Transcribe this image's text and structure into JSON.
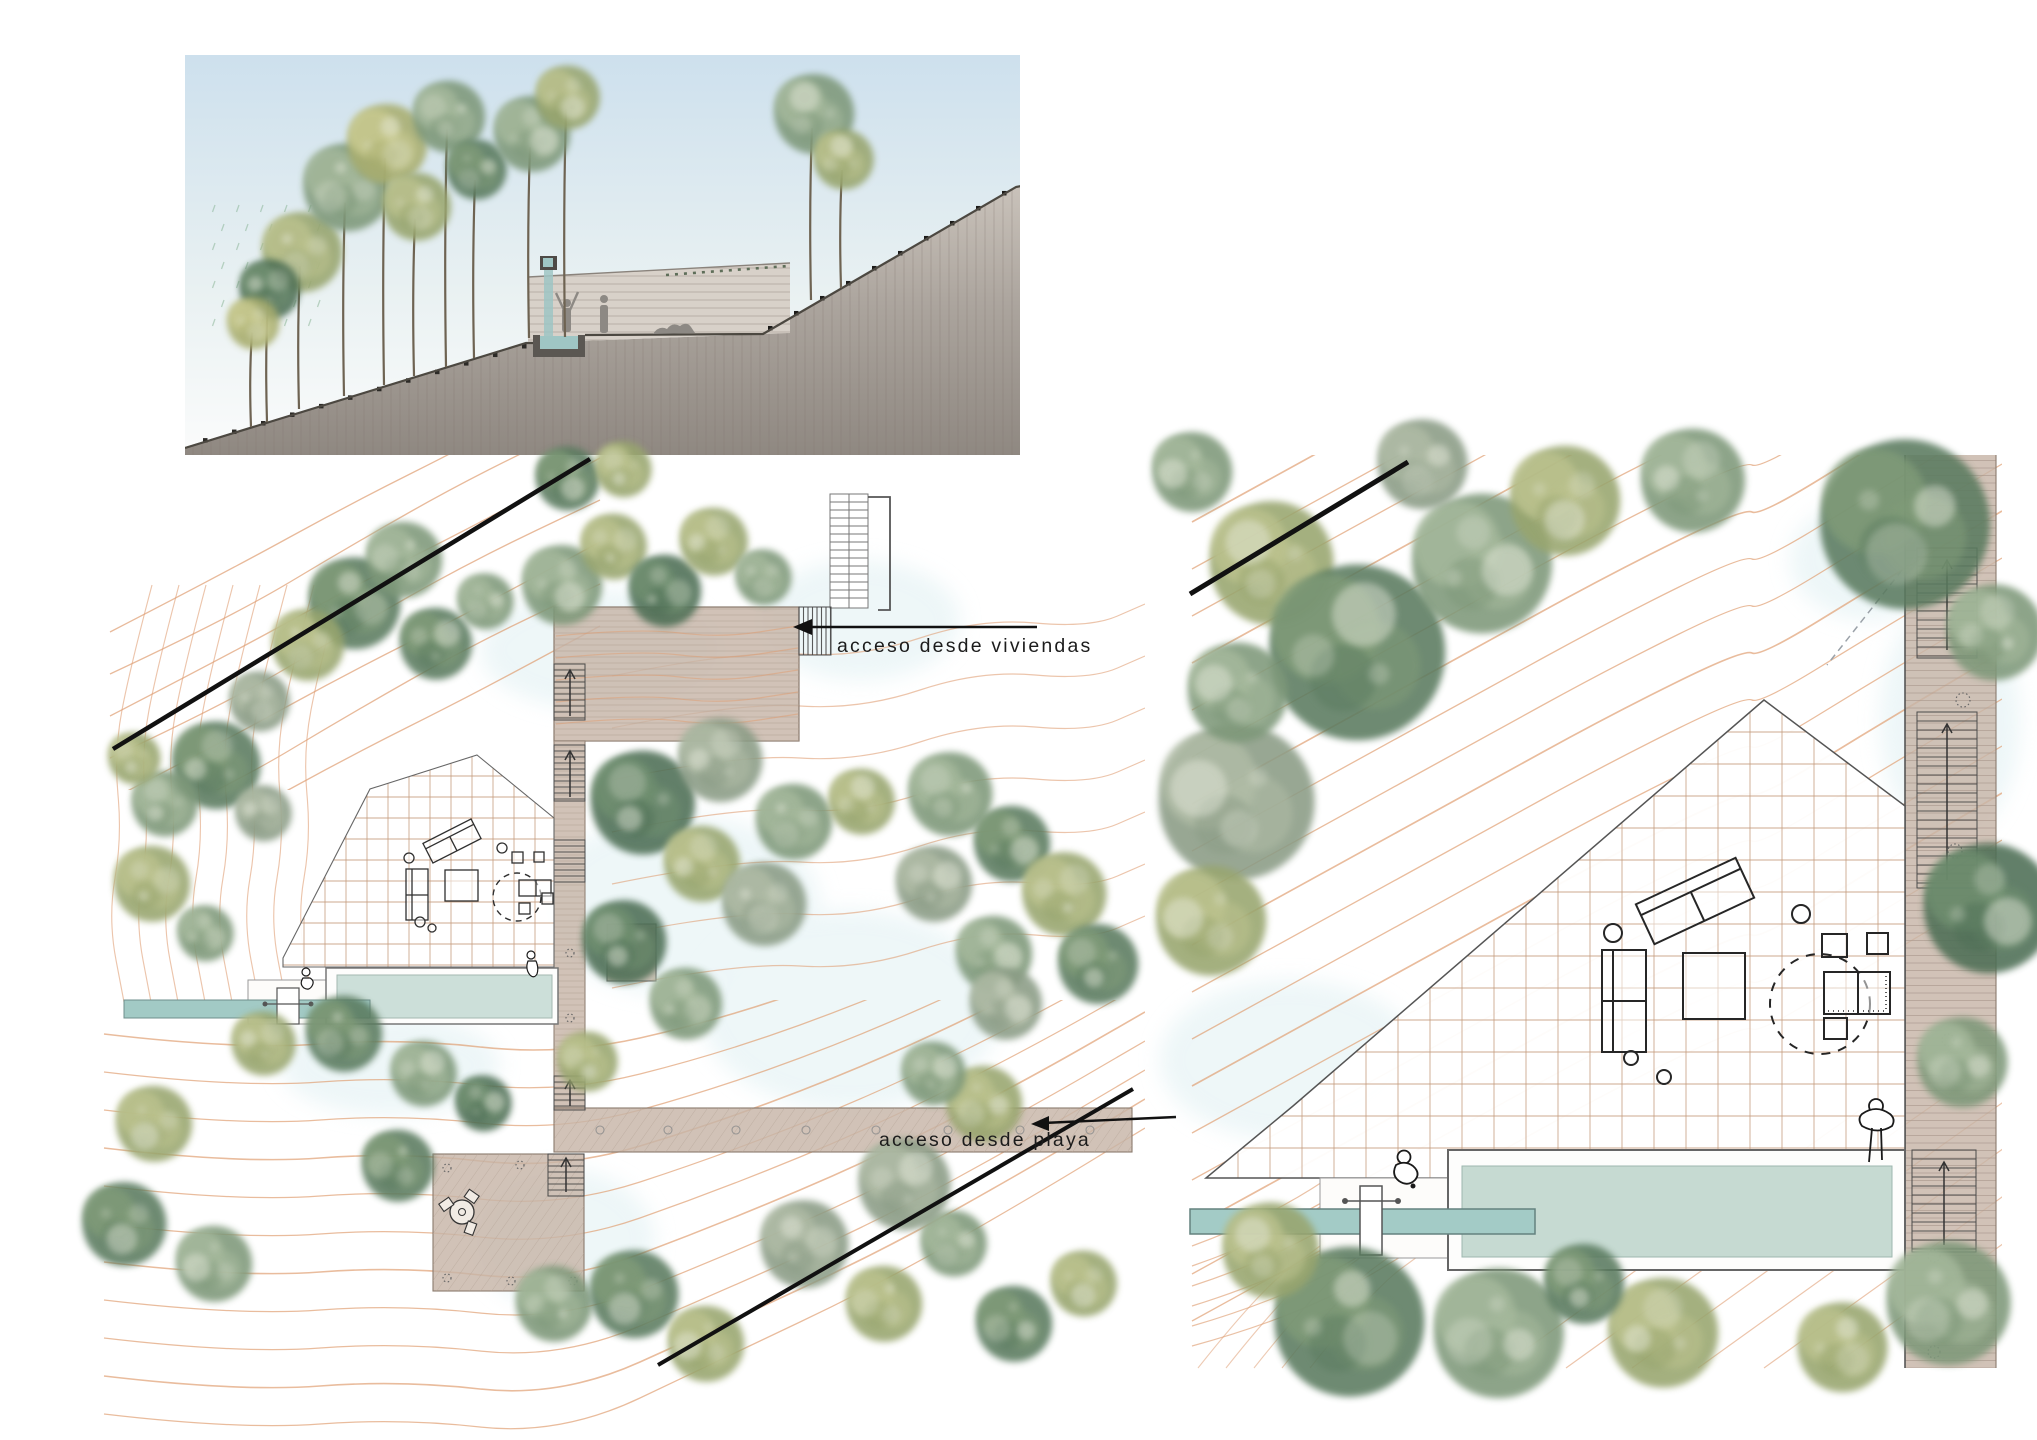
{
  "drawing": {
    "kind": "landscape architecture presentation",
    "labels": {
      "access_viviendas": "acceso desde viviendas",
      "access_playa": "acceso desde playa"
    },
    "palette": {
      "contour": "#df9f74",
      "deck_timber": "#c7b5a7",
      "pool_water": "#ccdfd9",
      "pool_water_detail": "#c6dad2",
      "water_channel": "#a3cbc6",
      "sky_top": "#cde0ed",
      "ground_wash": "#948d86",
      "boundary_line": "#111111",
      "tree_greens": [
        "#5a7a5e",
        "#7e9879",
        "#98a56e",
        "#8a9b85",
        "#a9ae6f",
        "#4e6e54"
      ]
    }
  }
}
